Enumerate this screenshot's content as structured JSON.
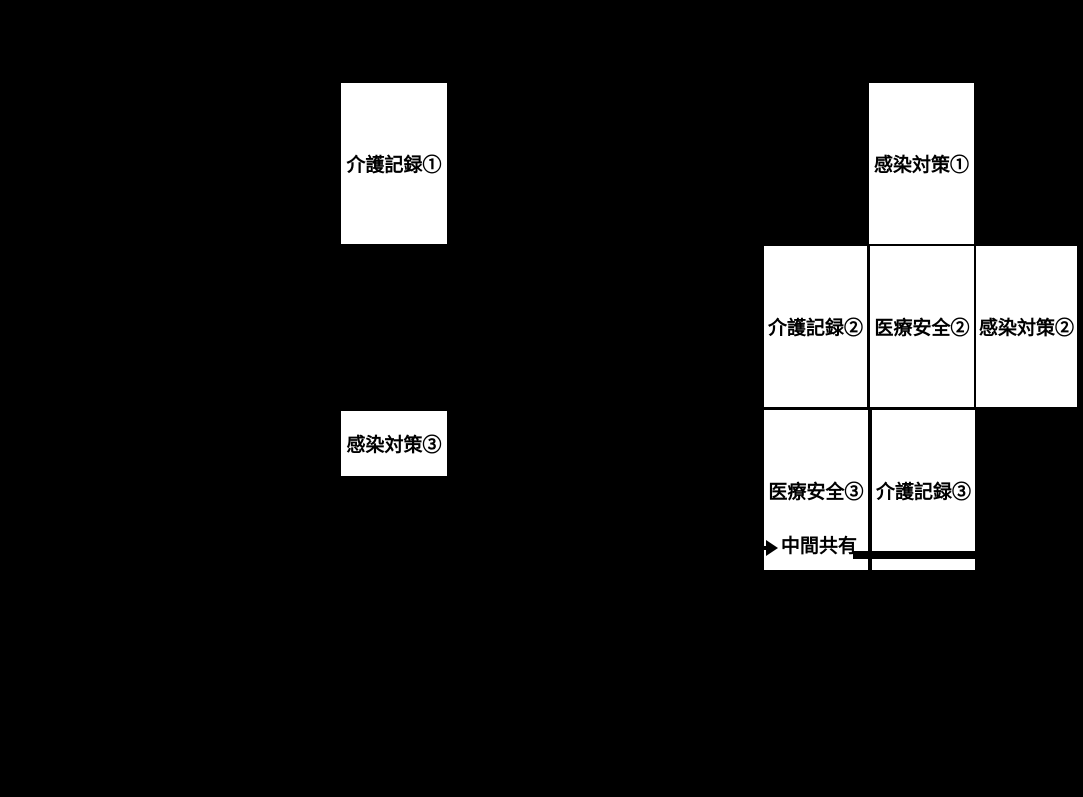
{
  "colors": {
    "background": "#000000",
    "box_fill": "#ffffff",
    "box_text": "#000000",
    "line": "#000000"
  },
  "boxes": [
    {
      "id": "care-record-1",
      "label": "介護記録①"
    },
    {
      "id": "infection-control-3",
      "label": "感染対策③"
    },
    {
      "id": "infection-control-1",
      "label": "感染対策①"
    },
    {
      "id": "care-record-2",
      "label": "介護記録②"
    },
    {
      "id": "medical-safety-2",
      "label": "医療安全②"
    },
    {
      "id": "infection-control-2",
      "label": "感染対策②"
    },
    {
      "id": "medical-safety-3",
      "label": "医療安全③"
    },
    {
      "id": "care-record-3",
      "label": "介護記録③"
    }
  ],
  "annotations": {
    "mid_share": "中間共有"
  }
}
